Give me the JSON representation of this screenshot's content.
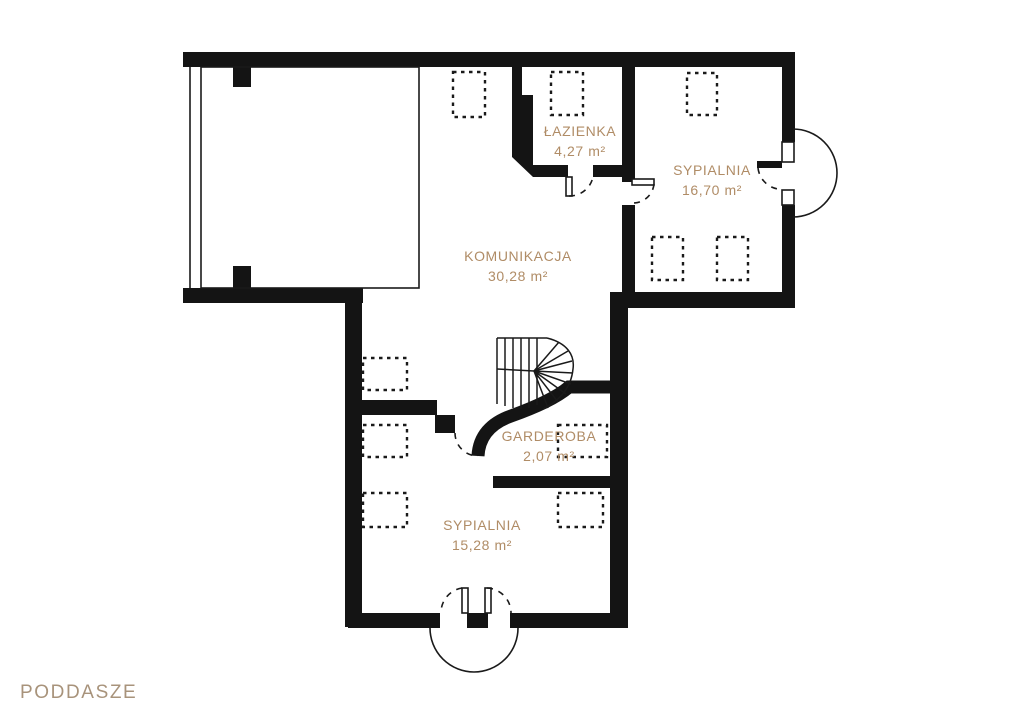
{
  "page": {
    "title": "PODDASZE"
  },
  "palette": {
    "wall": "#141414",
    "line": "#1a1a1a",
    "room_label": "#b08c66",
    "floor_label": "#a8937b",
    "background": "#ffffff"
  },
  "rooms": [
    {
      "name": "ŁAZIENKA",
      "area": "4,27 m²"
    },
    {
      "name": "SYPIALNIA",
      "area": "16,70 m²"
    },
    {
      "name": "KOMUNIKACJA",
      "area": "30,28 m²"
    },
    {
      "name": "GARDEROBA",
      "area": "2,07 m²"
    },
    {
      "name": "SYPIALNIA",
      "area": "15,28 m²"
    }
  ]
}
